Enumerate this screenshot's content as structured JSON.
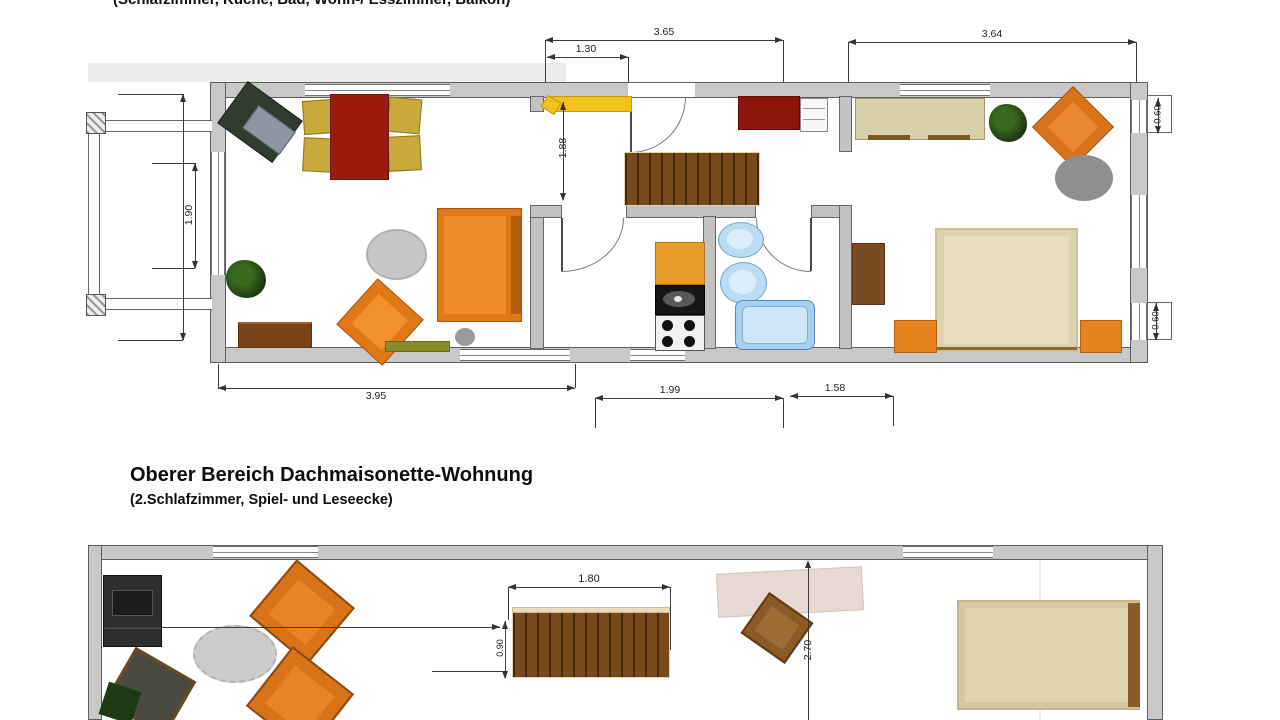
{
  "captions": {
    "top_partial": "(Schlafzimmer, Küche, Bad, Wohn-/ Esszimmer, Balkon)"
  },
  "section": {
    "title": "Oberer Bereich Dachmaisonette-Wohnung",
    "subtitle": "(2.Schlafzimmer, Spiel- und Leseecke)"
  },
  "plan1": {
    "name": "lower-level-floorplan",
    "dims": {
      "top_total": "3.65",
      "top_inner": "1.30",
      "top_right": "3.64",
      "bottom_left": "3.95",
      "bottom_center": "1.99",
      "bottom_right": "1.58",
      "balcony_door": "1.90",
      "hall_opening": "1.88",
      "window_top": "0.60",
      "window_bottom": "0.60"
    }
  },
  "plan2": {
    "name": "upper-level-floorplan",
    "dims": {
      "stairs_length": "1.80",
      "stairs_width": "0.90",
      "room_depth": "2.70"
    }
  },
  "colors": {
    "wall_gray": "#c8c8c8",
    "furniture_orange": "#d9731a",
    "stairs_wood": "#77491b",
    "dining_table_red": "#9b1c0e",
    "chair_mustard": "#c9a93a",
    "bath_blue": "#a8d0ee",
    "bed_beige": "#ddd2b0",
    "sideboard_yellow": "#f2c11e",
    "bed_red": "#8e150b"
  }
}
